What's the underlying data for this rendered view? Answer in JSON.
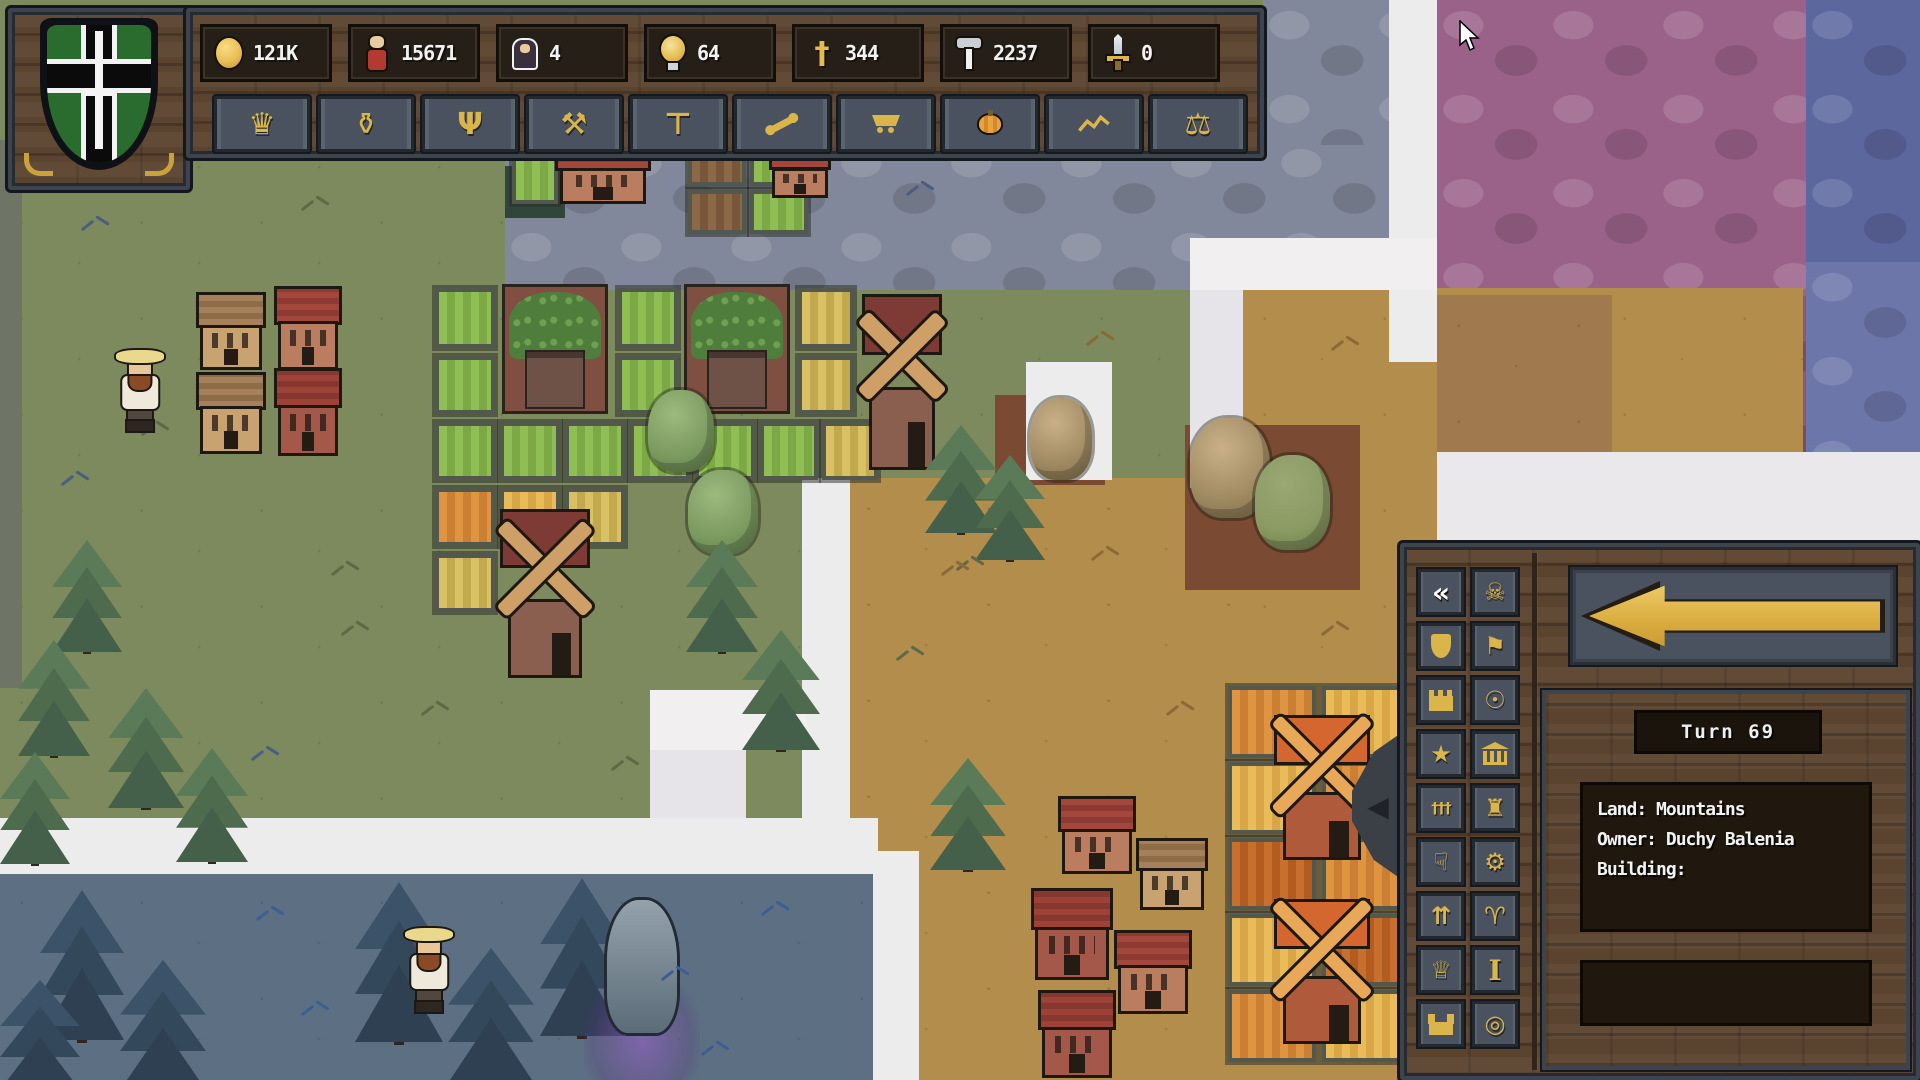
{
  "colors": {
    "accent_gold": "#D9B54A",
    "panel_wood": "#5B442F",
    "panel_slate": "#49525E",
    "frame_slate": "#3E444E",
    "fog": "#EDECEC"
  },
  "emblem": {
    "name": "duchy-crest",
    "shield_green": "#2A6B2E",
    "cross_black": "#0B0B0B",
    "cross_outline": "#F2F2F2",
    "sword_white": "#F4F4F4"
  },
  "top_bar": {
    "resources": [
      {
        "name": "gold",
        "icon": "gold-coin",
        "value": "121K"
      },
      {
        "name": "population",
        "icon": "villager",
        "value": "15671"
      },
      {
        "name": "clergy",
        "icon": "monk",
        "value": "4"
      },
      {
        "name": "ideas",
        "icon": "bulb",
        "value": "64"
      },
      {
        "name": "faith",
        "icon": "cross",
        "value": "344"
      },
      {
        "name": "labour",
        "icon": "hammer",
        "value": "2237"
      },
      {
        "name": "military",
        "icon": "sword",
        "value": "0"
      }
    ],
    "menu_buttons": [
      {
        "icon": "crown"
      },
      {
        "icon": "trophy"
      },
      {
        "icon": "candelabra"
      },
      {
        "icon": "pickaxe"
      },
      {
        "icon": "gavel"
      },
      {
        "icon": "bone"
      },
      {
        "icon": "cart"
      },
      {
        "icon": "pumpkin"
      },
      {
        "icon": "chart"
      },
      {
        "icon": "scales"
      }
    ]
  },
  "side_panel": {
    "turn_label": "Turn 69",
    "info": {
      "lines": [
        "Land: Mountains",
        "Owner: Duchy Balenia",
        "Building:"
      ]
    },
    "back_button": {
      "icon": "big-left-arrow"
    },
    "tool_buttons": [
      {
        "icon": "collapse-arrows",
        "active": true
      },
      {
        "icon": "skull"
      },
      {
        "icon": "shield-gold"
      },
      {
        "icon": "banner"
      },
      {
        "icon": "wall"
      },
      {
        "icon": "coin-mark"
      },
      {
        "icon": "figure-star"
      },
      {
        "icon": "temple"
      },
      {
        "icon": "graveyard"
      },
      {
        "icon": "tower"
      },
      {
        "icon": "thumbs-down"
      },
      {
        "icon": "gear"
      },
      {
        "icon": "growth-arrows"
      },
      {
        "icon": "ram"
      },
      {
        "icon": "crown-keep"
      },
      {
        "icon": "info-i"
      },
      {
        "icon": "castle"
      },
      {
        "icon": "token-circle"
      }
    ]
  },
  "cursor": {
    "x": 1458,
    "y": 20
  },
  "map": {
    "regions": [
      {
        "name": "grass-base",
        "x": 0,
        "y": 0,
        "w": 1920,
        "h": 1080,
        "c": "#7C8A5E",
        "tx": "grass"
      },
      {
        "name": "west-edge-shadow",
        "x": 0,
        "y": 140,
        "w": 22,
        "h": 548,
        "c": "#6E7566"
      },
      {
        "name": "stone-mountains-top",
        "x": 505,
        "y": 138,
        "w": 885,
        "h": 152,
        "c": "#82889B",
        "tx": "cobble"
      },
      {
        "name": "stone-mountains-ne",
        "x": 1263,
        "y": 0,
        "w": 126,
        "h": 145,
        "c": "#82889B",
        "tx": "cobble"
      },
      {
        "name": "purple-stone",
        "x": 1437,
        "y": 0,
        "w": 372,
        "h": 296,
        "c": "#9B6289",
        "tx": "cobble"
      },
      {
        "name": "purple-stone-low",
        "x": 1610,
        "y": 296,
        "w": 197,
        "h": 160,
        "c": "#8A5878",
        "tx": "cobble"
      },
      {
        "name": "blue-stone-corner",
        "x": 1806,
        "y": 0,
        "w": 114,
        "h": 262,
        "c": "#5C679E",
        "tx": "cobble"
      },
      {
        "name": "blue-stone-right",
        "x": 1806,
        "y": 262,
        "w": 114,
        "h": 196,
        "c": "#6C76A9",
        "tx": "cobble"
      },
      {
        "name": "tan-steppe-main",
        "x": 1243,
        "y": 288,
        "w": 560,
        "h": 792,
        "c": "#B38D4C",
        "tx": "grass"
      },
      {
        "name": "tan-steppe-dark",
        "x": 1437,
        "y": 295,
        "w": 175,
        "h": 160,
        "c": "#A07A4E",
        "tx": "grass"
      },
      {
        "name": "tan-steppe-west",
        "x": 847,
        "y": 478,
        "w": 400,
        "h": 602,
        "c": "#B38D4C",
        "tx": "grass"
      },
      {
        "name": "red-patch",
        "x": 1737,
        "y": 452,
        "w": 85,
        "h": 70,
        "c": "#AE5F5C"
      },
      {
        "name": "pond",
        "x": 505,
        "y": 166,
        "w": 60,
        "h": 52,
        "c": "#32453B"
      },
      {
        "name": "dirt-patch",
        "x": 1185,
        "y": 425,
        "w": 175,
        "h": 165,
        "c": "#7B4A33"
      },
      {
        "name": "dirt-patch-small",
        "x": 995,
        "y": 395,
        "w": 110,
        "h": 90,
        "c": "#7B4A33"
      },
      {
        "name": "night-meadow",
        "x": 0,
        "y": 872,
        "w": 878,
        "h": 208,
        "c": "#5D7083",
        "tx": "grass"
      },
      {
        "name": "fog-1",
        "x": 1389,
        "y": 0,
        "w": 48,
        "h": 362,
        "c": "#EDECEC"
      },
      {
        "name": "fog-2",
        "x": 1190,
        "y": 238,
        "w": 247,
        "h": 52,
        "c": "#F1EFEF"
      },
      {
        "name": "fog-3",
        "x": 1190,
        "y": 290,
        "w": 53,
        "h": 198,
        "c": "#E6E4E8"
      },
      {
        "name": "fog-4",
        "x": 1026,
        "y": 362,
        "w": 86,
        "h": 118,
        "c": "#EDECEC"
      },
      {
        "name": "fog-5",
        "x": 802,
        "y": 478,
        "w": 48,
        "h": 382,
        "c": "#EDECEC"
      },
      {
        "name": "fog-6",
        "x": 650,
        "y": 690,
        "w": 156,
        "h": 60,
        "c": "#F1EFEF"
      },
      {
        "name": "fog-7",
        "x": 650,
        "y": 750,
        "w": 96,
        "h": 108,
        "c": "#E6E4E8"
      },
      {
        "name": "fog-8",
        "x": 0,
        "y": 818,
        "w": 878,
        "h": 56,
        "c": "#EDECEC"
      },
      {
        "name": "fog-9",
        "x": 1437,
        "y": 452,
        "w": 483,
        "h": 92,
        "c": "#EAE8EA"
      },
      {
        "name": "fog-10",
        "x": 873,
        "y": 851,
        "w": 46,
        "h": 229,
        "c": "#EDECEC"
      }
    ],
    "sprites": [
      {
        "t": "plot",
        "v": "g",
        "x": 512,
        "y": 146,
        "w": 46,
        "h": 58
      },
      {
        "t": "plot",
        "v": "b",
        "x": 688,
        "y": 142,
        "w": 58,
        "h": 44
      },
      {
        "t": "plot",
        "v": "b",
        "x": 688,
        "y": 190,
        "w": 58,
        "h": 44
      },
      {
        "t": "plot",
        "v": "g",
        "x": 750,
        "y": 142,
        "w": 58,
        "h": 44
      },
      {
        "t": "plot",
        "v": "g",
        "x": 750,
        "y": 190,
        "w": 58,
        "h": 44
      },
      {
        "t": "plot",
        "v": "g",
        "x": 435,
        "y": 288,
        "w": 60,
        "h": 60
      },
      {
        "t": "plot",
        "v": "g",
        "x": 618,
        "y": 288,
        "w": 60,
        "h": 60
      },
      {
        "t": "plot",
        "v": "y",
        "x": 798,
        "y": 288,
        "w": 56,
        "h": 60
      },
      {
        "t": "plot",
        "v": "g",
        "x": 435,
        "y": 356,
        "w": 60,
        "h": 58
      },
      {
        "t": "plot",
        "v": "g",
        "x": 618,
        "y": 356,
        "w": 60,
        "h": 58
      },
      {
        "t": "plot",
        "v": "y",
        "x": 798,
        "y": 356,
        "w": 56,
        "h": 58
      },
      {
        "t": "plot",
        "v": "g",
        "x": 435,
        "y": 422,
        "w": 60,
        "h": 58
      },
      {
        "t": "plot",
        "v": "g",
        "x": 500,
        "y": 422,
        "w": 60,
        "h": 58
      },
      {
        "t": "plot",
        "v": "g",
        "x": 565,
        "y": 422,
        "w": 60,
        "h": 58
      },
      {
        "t": "plot",
        "v": "g",
        "x": 630,
        "y": 422,
        "w": 60,
        "h": 58
      },
      {
        "t": "plot",
        "v": "g",
        "x": 695,
        "y": 422,
        "w": 60,
        "h": 58
      },
      {
        "t": "plot",
        "v": "g",
        "x": 760,
        "y": 422,
        "w": 58,
        "h": 58
      },
      {
        "t": "plot",
        "v": "y",
        "x": 822,
        "y": 422,
        "w": 56,
        "h": 58
      },
      {
        "t": "plot",
        "v": "o",
        "x": 435,
        "y": 488,
        "w": 60,
        "h": 58
      },
      {
        "t": "plot",
        "v": "y2",
        "x": 500,
        "y": 488,
        "w": 60,
        "h": 58
      },
      {
        "t": "plot",
        "v": "y",
        "x": 565,
        "y": 488,
        "w": 60,
        "h": 58
      },
      {
        "t": "plot",
        "v": "y",
        "x": 435,
        "y": 554,
        "w": 60,
        "h": 58
      },
      {
        "t": "plot",
        "v": "o",
        "x": 1228,
        "y": 686,
        "w": 88,
        "h": 72
      },
      {
        "t": "plot",
        "v": "y2",
        "x": 1322,
        "y": 686,
        "w": 88,
        "h": 72
      },
      {
        "t": "plot",
        "v": "y2",
        "x": 1228,
        "y": 762,
        "w": 88,
        "h": 72
      },
      {
        "t": "plot",
        "v": "o",
        "x": 1322,
        "y": 762,
        "w": 88,
        "h": 72
      },
      {
        "t": "plot",
        "v": "o2",
        "x": 1228,
        "y": 838,
        "w": 88,
        "h": 72
      },
      {
        "t": "plot",
        "v": "o",
        "x": 1322,
        "y": 838,
        "w": 88,
        "h": 72
      },
      {
        "t": "plot",
        "v": "y2",
        "x": 1228,
        "y": 914,
        "w": 88,
        "h": 72
      },
      {
        "t": "plot",
        "v": "o2",
        "x": 1322,
        "y": 914,
        "w": 88,
        "h": 72
      },
      {
        "t": "plot",
        "v": "o",
        "x": 1228,
        "y": 990,
        "w": 88,
        "h": 72
      },
      {
        "t": "plot",
        "v": "y2",
        "x": 1322,
        "y": 990,
        "w": 88,
        "h": 72
      },
      {
        "t": "hop",
        "x": 502,
        "y": 284,
        "w": 106,
        "h": 130
      },
      {
        "t": "hop",
        "x": 684,
        "y": 284,
        "w": 106,
        "h": 130
      },
      {
        "t": "house",
        "v": "tan",
        "x": 200,
        "y": 292,
        "w": 62,
        "h": 78
      },
      {
        "t": "house",
        "v": "red",
        "x": 278,
        "y": 286,
        "w": 60,
        "h": 84
      },
      {
        "t": "house",
        "v": "tan",
        "x": 200,
        "y": 372,
        "w": 62,
        "h": 82
      },
      {
        "t": "house",
        "v": "red3",
        "x": 278,
        "y": 368,
        "w": 60,
        "h": 88
      },
      {
        "t": "house",
        "v": "red",
        "x": 560,
        "y": 142,
        "w": 86,
        "h": 62
      },
      {
        "t": "house",
        "v": "red",
        "x": 772,
        "y": 146,
        "w": 56,
        "h": 52
      },
      {
        "t": "house",
        "v": "red",
        "x": 1062,
        "y": 796,
        "w": 70,
        "h": 78
      },
      {
        "t": "house",
        "v": "tan",
        "x": 1140,
        "y": 838,
        "w": 64,
        "h": 72
      },
      {
        "t": "house",
        "v": "red3",
        "x": 1035,
        "y": 888,
        "w": 74,
        "h": 92
      },
      {
        "t": "house",
        "v": "red",
        "x": 1118,
        "y": 930,
        "w": 70,
        "h": 84
      },
      {
        "t": "house",
        "v": "red3",
        "x": 1042,
        "y": 990,
        "w": 70,
        "h": 88
      },
      {
        "t": "mill",
        "v": "b",
        "x": 856,
        "y": 290,
        "w": 92,
        "h": 180
      },
      {
        "t": "mill",
        "v": "b",
        "x": 494,
        "y": 506,
        "w": 102,
        "h": 172
      },
      {
        "t": "mill",
        "v": "o",
        "x": 1268,
        "y": 712,
        "w": 108,
        "h": 148
      },
      {
        "t": "mill",
        "v": "o",
        "x": 1268,
        "y": 896,
        "w": 108,
        "h": 148
      },
      {
        "t": "tree",
        "v": "g",
        "x": 648,
        "y": 390,
        "w": 66,
        "h": 82
      },
      {
        "t": "tree",
        "v": "g",
        "x": 688,
        "y": 470,
        "w": 70,
        "h": 84
      },
      {
        "t": "pine",
        "v": "g",
        "x": 686,
        "y": 540,
        "w": 72,
        "h": 112
      },
      {
        "t": "pine",
        "v": "g",
        "x": 742,
        "y": 630,
        "w": 78,
        "h": 120
      },
      {
        "t": "pine",
        "v": "g",
        "x": 52,
        "y": 540,
        "w": 70,
        "h": 112
      },
      {
        "t": "pine",
        "v": "g",
        "x": 18,
        "y": 640,
        "w": 72,
        "h": 116
      },
      {
        "t": "pine",
        "v": "g",
        "x": 108,
        "y": 688,
        "w": 76,
        "h": 120
      },
      {
        "t": "pine",
        "v": "g",
        "x": 0,
        "y": 752,
        "w": 70,
        "h": 112
      },
      {
        "t": "pine",
        "v": "g",
        "x": 176,
        "y": 748,
        "w": 72,
        "h": 114
      },
      {
        "t": "pine",
        "v": "g",
        "x": 925,
        "y": 425,
        "w": 72,
        "h": 108
      },
      {
        "t": "pine",
        "v": "g",
        "x": 975,
        "y": 455,
        "w": 70,
        "h": 105
      },
      {
        "t": "pine",
        "v": "g",
        "x": 930,
        "y": 758,
        "w": 76,
        "h": 112
      },
      {
        "t": "tree",
        "v": "dry",
        "x": 1190,
        "y": 418,
        "w": 80,
        "h": 100
      },
      {
        "t": "tree",
        "v": "dry2",
        "x": 1255,
        "y": 455,
        "w": 75,
        "h": 95
      },
      {
        "t": "tree",
        "v": "dry",
        "x": 1030,
        "y": 398,
        "w": 62,
        "h": 82
      },
      {
        "t": "pine",
        "v": "n",
        "x": 40,
        "y": 890,
        "w": 84,
        "h": 150
      },
      {
        "t": "pine",
        "v": "n",
        "x": 120,
        "y": 960,
        "w": 86,
        "h": 130
      },
      {
        "t": "pine",
        "v": "n",
        "x": 0,
        "y": 980,
        "w": 80,
        "h": 110
      },
      {
        "t": "pine",
        "v": "n",
        "x": 355,
        "y": 882,
        "w": 88,
        "h": 160
      },
      {
        "t": "pine",
        "v": "n",
        "x": 448,
        "y": 948,
        "w": 86,
        "h": 135
      },
      {
        "t": "pine",
        "v": "n",
        "x": 540,
        "y": 878,
        "w": 84,
        "h": 158
      },
      {
        "t": "shrine",
        "x": 592,
        "y": 900,
        "w": 100,
        "h": 180
      },
      {
        "t": "villager",
        "x": 116,
        "y": 350,
        "w": 48,
        "h": 92
      },
      {
        "t": "villager",
        "x": 405,
        "y": 928,
        "w": 48,
        "h": 96
      },
      {
        "t": "tuft",
        "v": "b",
        "x": 80,
        "y": 215
      },
      {
        "t": "tuft",
        "v": "g",
        "x": 300,
        "y": 195
      },
      {
        "t": "tuft",
        "v": "g",
        "x": 140,
        "y": 420
      },
      {
        "t": "tuft",
        "v": "b",
        "x": 60,
        "y": 470
      },
      {
        "t": "tuft",
        "v": "g",
        "x": 330,
        "y": 560
      },
      {
        "t": "tuft",
        "v": "b",
        "x": 250,
        "y": 745
      },
      {
        "t": "tuft",
        "v": "g",
        "x": 420,
        "y": 700
      },
      {
        "t": "tuft",
        "v": "g",
        "x": 610,
        "y": 755
      },
      {
        "t": "tuft",
        "v": "b",
        "x": 905,
        "y": 180
      },
      {
        "t": "tuft",
        "v": "g",
        "x": 955,
        "y": 555
      },
      {
        "t": "tuft",
        "v": "g",
        "x": 895,
        "y": 645
      },
      {
        "t": "tuft",
        "v": "g",
        "x": 340,
        "y": 620
      },
      {
        "t": "tuft",
        "v": "t",
        "x": 1085,
        "y": 330
      },
      {
        "t": "tuft",
        "v": "t",
        "x": 1330,
        "y": 335
      },
      {
        "t": "tuft",
        "v": "t",
        "x": 1090,
        "y": 545
      },
      {
        "t": "tuft",
        "v": "t",
        "x": 1320,
        "y": 620
      },
      {
        "t": "tuft",
        "v": "t",
        "x": 1165,
        "y": 700
      },
      {
        "t": "tuft",
        "v": "t",
        "x": 940,
        "y": 560
      },
      {
        "t": "tuft",
        "v": "n",
        "x": 255,
        "y": 905
      },
      {
        "t": "tuft",
        "v": "n",
        "x": 300,
        "y": 1000
      },
      {
        "t": "tuft",
        "v": "n",
        "x": 660,
        "y": 965
      },
      {
        "t": "tuft",
        "v": "n",
        "x": 760,
        "y": 900
      },
      {
        "t": "tuft",
        "v": "n",
        "x": 700,
        "y": 1040
      }
    ]
  }
}
